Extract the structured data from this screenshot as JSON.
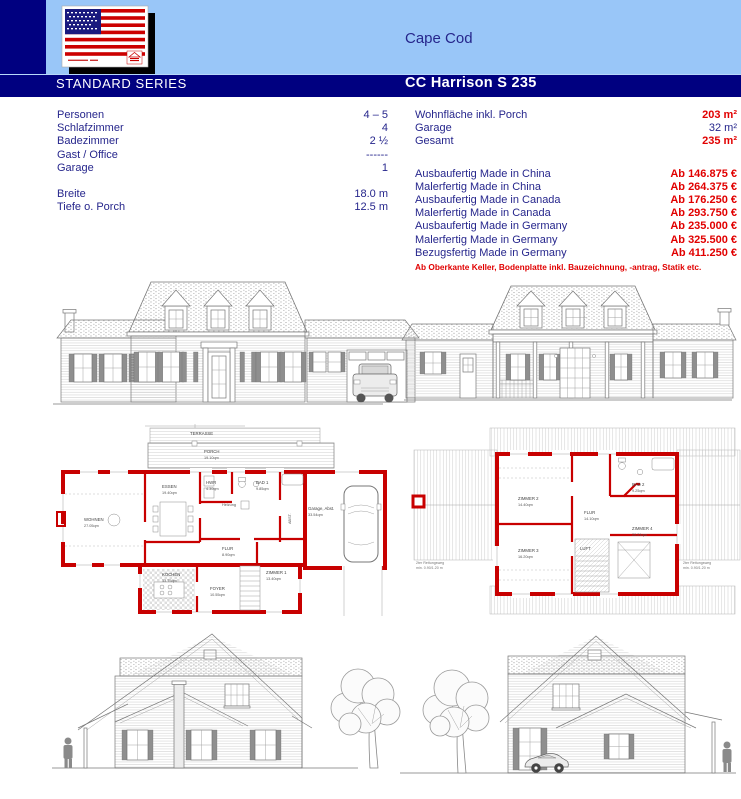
{
  "colors": {
    "navy_bar": "#000080",
    "header_blue": "#99C6F8",
    "text_navy": "#26268C",
    "price_red": "#E10000",
    "plan_wall_red": "#C80000"
  },
  "header": {
    "style_title": "Cape Cod",
    "series_label": "STANDARD SERIES",
    "model_name": "CC Harrison S 235",
    "logo_icon": "us-flag-logo"
  },
  "specs": {
    "left": [
      {
        "label": "Personen",
        "value": "4 – 5"
      },
      {
        "label": "Schlafzimmer",
        "value": "4"
      },
      {
        "label": "Badezimmer",
        "value": "2 ½"
      },
      {
        "label": "Gast / Office",
        "value": "------"
      },
      {
        "label": "Garage",
        "value": "1"
      }
    ],
    "dimensions": [
      {
        "label": "Breite",
        "value": "18.0 m"
      },
      {
        "label": "Tiefe o. Porch",
        "value": "12.5 m"
      }
    ],
    "areas": [
      {
        "label": "Wohnfläche inkl. Porch",
        "value": "203 m²"
      },
      {
        "label": "Garage",
        "value": "32 m²"
      },
      {
        "label": "Gesamt",
        "value": "235 m²"
      }
    ],
    "prices": [
      {
        "label": "Ausbaufertig Made in China",
        "value": "Ab 146.875 €"
      },
      {
        "label": "Malerfertig Made in China",
        "value": "Ab 264.375 €"
      },
      {
        "label": "Ausbaufertig Made in Canada",
        "value": "Ab 176.250 €"
      },
      {
        "label": "Malerfertig Made in Canada",
        "value": "Ab 293.750 €"
      },
      {
        "label": "Ausbaufertig Made in Germany",
        "value": "Ab 235.000 €"
      },
      {
        "label": "Malerfertig Made in Germany",
        "value": "Ab 325.500 €"
      },
      {
        "label": "Bezugsfertig Made in Germany",
        "value": "Ab 411.250 €"
      }
    ],
    "price_footnote": "Ab Oberkante Keller, Bodenplatte inkl. Bauzeichnung, -antrag, Statik etc."
  },
  "plans": {
    "eg_rooms": {
      "terrasse": "TERRASSE",
      "porch": "PORCH",
      "porch_area": "19.10qm",
      "wohnen": "WOHNEN",
      "wohnen_area": "27.05qm",
      "essen": "ESSEN",
      "essen_area": "19.40qm",
      "hwr": "HWR",
      "hwr_area": "4.30qm",
      "heizung": "Heizung",
      "bad1": "BAD 1",
      "bad1_area": "9.85qm",
      "abst": "ABST.",
      "flur": "FLUR",
      "flur_area": "8.90qm",
      "kochen": "KOCHEN",
      "kochen_area": "13.75qm",
      "foyer": "FOYER",
      "foyer_area": "10.55qm",
      "zimmer1": "ZIMMER 1",
      "zimmer1_area": "13.40qm",
      "garage": "Garage, Abst.",
      "garage_area": "33.54qm"
    },
    "og_rooms": {
      "zimmer2": "ZIMMER 2",
      "zimmer2_area": "14.40qm",
      "zimmer3": "ZIMMER 3",
      "zimmer3_area": "16.20qm",
      "zimmer4": "ZIMMER 4",
      "zimmer4_area": "20.21qm",
      "bad2": "BAD 2",
      "bad2_area": "9.25qm",
      "flur": "FLUR",
      "flur_area": "14.10qm",
      "luft": "LUFT",
      "rescue_note_line1": "2ter Rettungsweg",
      "rescue_note_line2": "min. 0.90/1.20 m"
    }
  }
}
